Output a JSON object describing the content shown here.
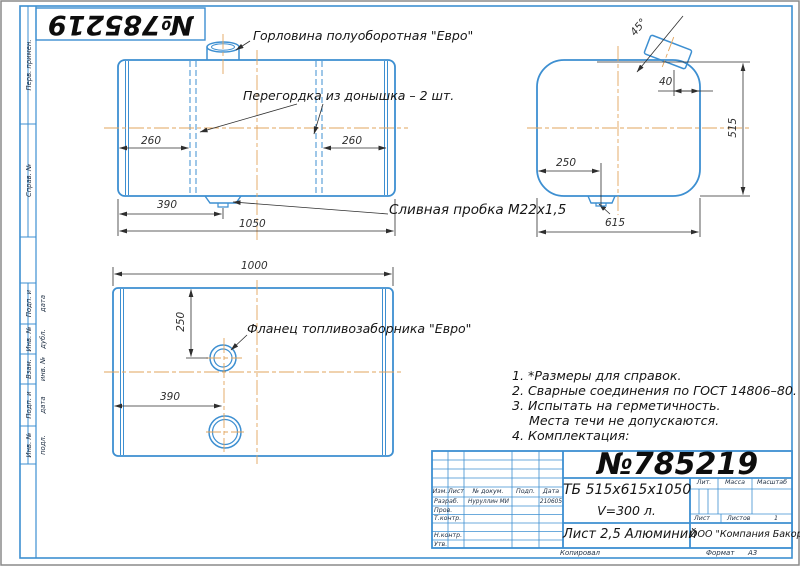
{
  "colors": {
    "line_blue": "#3d8fd1",
    "centerline_orange": "#e2a45c",
    "dim_gray": "#2e2e2e",
    "ink": "#161616"
  },
  "frame": {
    "stamp_number": "№785219",
    "margin_labels": [
      "Перв. примен.",
      "Справ. №",
      "Подп. и дата",
      "Инв. № дубл.",
      "Взам. инв. №",
      "Подп. и дата",
      "Инв. № подл."
    ]
  },
  "callouts": {
    "neck": "Горловина полуоборотная \"Евро\"",
    "baffle": "Перегордка из донышка – 2 шт.",
    "drain": "Сливная пробка М22х1,5",
    "flange": "Фланец топливозаборника \"Евро\""
  },
  "dimensions": {
    "front": {
      "baffle_left": "260",
      "baffle_right": "260",
      "drain_x": "390",
      "length": "1050"
    },
    "side": {
      "angle": "45°",
      "neck_offset": "40",
      "height": "515",
      "drain_x": "250",
      "width": "615"
    },
    "bottom": {
      "length": "1000",
      "flange_y": "250",
      "flange_x": "390"
    }
  },
  "notes": [
    "1. *Размеры для справок.",
    "2. Сварные соединения по ГОСТ 14806–80.",
    "3. Испытать на герметичность.",
    "Места течи не допускаются.",
    "4. Комплектация:"
  ],
  "title_block": {
    "doc_number": "№785219",
    "designation_line1": "ТБ 515х615х1050",
    "designation_line2": "V=300 л.",
    "material": "Лист 2,5 Алюминий",
    "company": "ООО \"Компания Бакор\"",
    "columns": {
      "izm": "Изм.",
      "list": "Лист",
      "doc": "№ докум.",
      "podp": "Подп.",
      "data": "Дата"
    },
    "rows": {
      "razrab": "Разраб.",
      "prov": "Пров.",
      "tkontr": "Т.контр.",
      "nkontr": "Н.контр.",
      "utv": "Утв."
    },
    "razrab_name": "Нуруллин МИ",
    "razrab_date": "210605",
    "lit_label": "Лит.",
    "massa_label": "Масса",
    "masshtab_label": "Масштаб",
    "list_label": "Лист",
    "listov_label": "Листов",
    "listov_value": "1",
    "kopiroval": "Копировал",
    "format_label": "Формат",
    "format_value": "А3"
  }
}
